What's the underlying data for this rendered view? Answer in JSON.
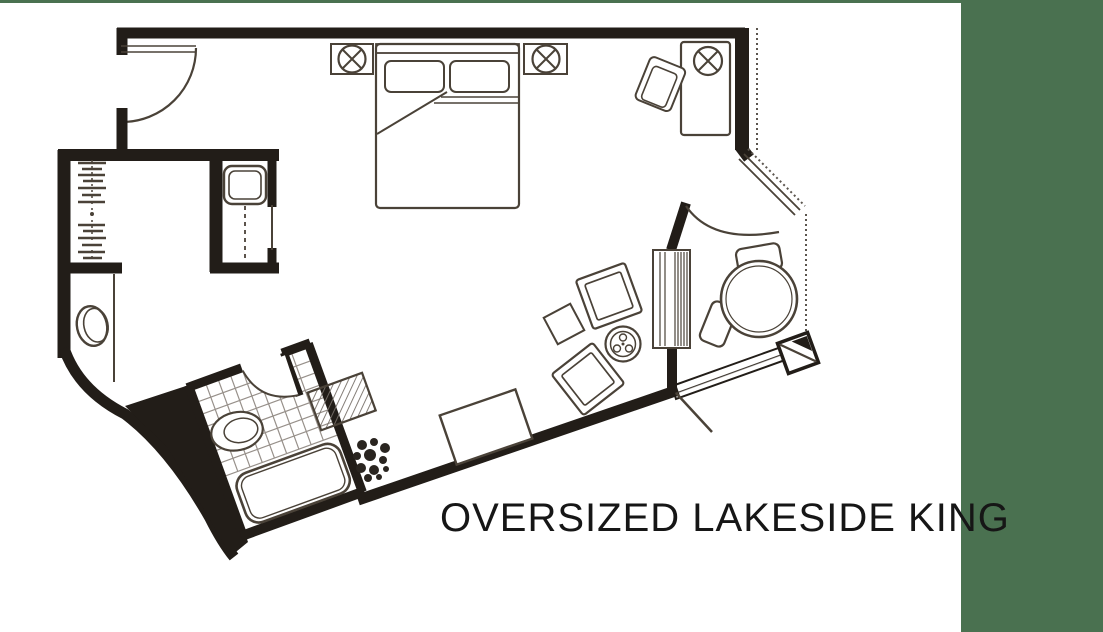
{
  "title": {
    "text": "OVERSIZED LAKESIDE KING"
  },
  "colors": {
    "accent_green": "#4a7150",
    "wall": "#221d18",
    "furniture_line": "#4a4238",
    "background": "#ffffff",
    "title_text": "#161616"
  },
  "floor_plan": {
    "type": "hotel-room-floor-plan",
    "room_label": "Oversized Lakeside King",
    "features": [
      "entry-door-with-swing",
      "closet-with-hangers",
      "luggage-cabinet-with-safe",
      "vanity-oval",
      "bathroom-with-tiled-floor",
      "toilet",
      "bathtub",
      "king-bed-with-two-pillows",
      "nightstand-lamp-left",
      "nightstand-lamp-right",
      "desk-with-lamp",
      "desk-chair",
      "lounge-chair-pair",
      "round-side-table",
      "console-unit",
      "dining-table-with-two-chairs",
      "balcony-door-with-swing",
      "deck-walkway-hatched",
      "bench-ottoman",
      "plant"
    ]
  }
}
